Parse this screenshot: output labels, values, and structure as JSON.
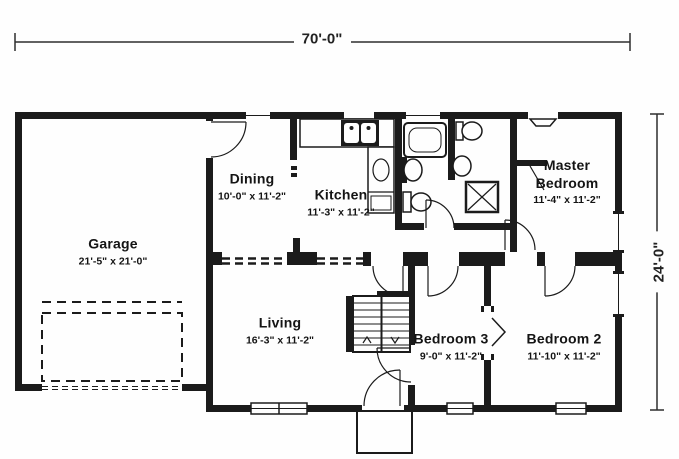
{
  "meta": {
    "type": "floor-plan",
    "style": "black line architectural drawing on white"
  },
  "colors": {
    "wall": "#1b1b1b",
    "line": "#2e2e2e",
    "background": "#fefefe",
    "text": "#141414"
  },
  "dimensions": {
    "width_label": "70'-0\"",
    "height_label": "24'-0\""
  },
  "rooms": {
    "garage": {
      "name": "Garage",
      "size": "21'-5\" x 21'-0\""
    },
    "dining": {
      "name": "Dining",
      "size": "10'-0\" x 11'-2\""
    },
    "kitchen": {
      "name": "Kitchen",
      "size": "11'-3\" x 11'-2\""
    },
    "master_bedroom": {
      "name": "Master Bedroom",
      "size": "11'-4\" x 11'-2\""
    },
    "living": {
      "name": "Living",
      "size": "16'-3\" x 11'-2\""
    },
    "bedroom3": {
      "name": "Bedroom 3",
      "size": "9'-0\" x 11'-2\""
    },
    "bedroom2": {
      "name": "Bedroom 2",
      "size": "11'-10\" x 11'-2\""
    }
  },
  "icons": {
    "bathtub": "bathtub-icon",
    "toilet": "toilet-icon",
    "sink": "sink-icon",
    "shower": "shower-icon",
    "stairs": "stairs-icon",
    "kitchen_sink": "kitchen-sink-icon",
    "garage_door": "garage-door-icon",
    "closet_door": "closet-chevron-icon",
    "porch": "porch-icon",
    "door": "door-swing-icon",
    "window": "window-icon"
  }
}
